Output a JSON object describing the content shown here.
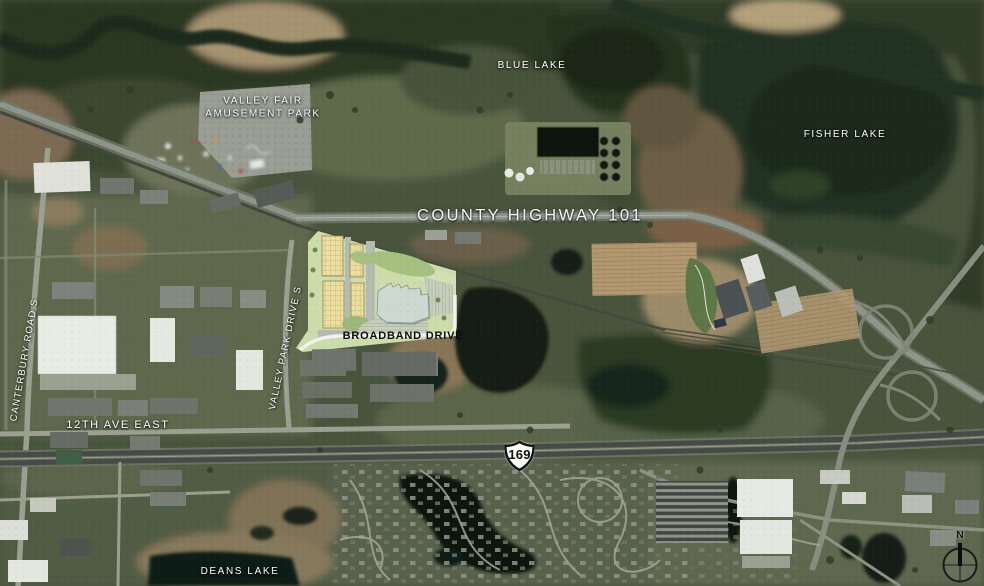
{
  "map": {
    "description": "aerial satellite map with site plan overlay",
    "labels": {
      "blue_lake": "BLUE LAKE",
      "fisher_lake": "FISHER LAKE",
      "valley_fair_line1": "VALLEY FAIR",
      "valley_fair_line2": "AMUSEMENT PARK",
      "county_highway_101": "COUNTY HIGHWAY 101",
      "broadband_drive": "BROADBAND DRIVE",
      "canterbury_road": "CANTERBURY ROAD S",
      "valley_park_drive": "VALLEY PARK DRIVE S",
      "twelfth_ave": "12TH AVE EAST",
      "deans_lake": "DEANS LAKE"
    },
    "highway_shield": {
      "route": "169"
    },
    "compass": {
      "north": "N"
    },
    "colors": {
      "site_plan_green": "#ccdcaa",
      "proposed_building_yellow": "#ecdfa0",
      "main_building_gray": "#ccd9d2",
      "label_white": "#ffffff",
      "shield_fill": "#f8f8f5",
      "shield_border": "#111111"
    }
  }
}
